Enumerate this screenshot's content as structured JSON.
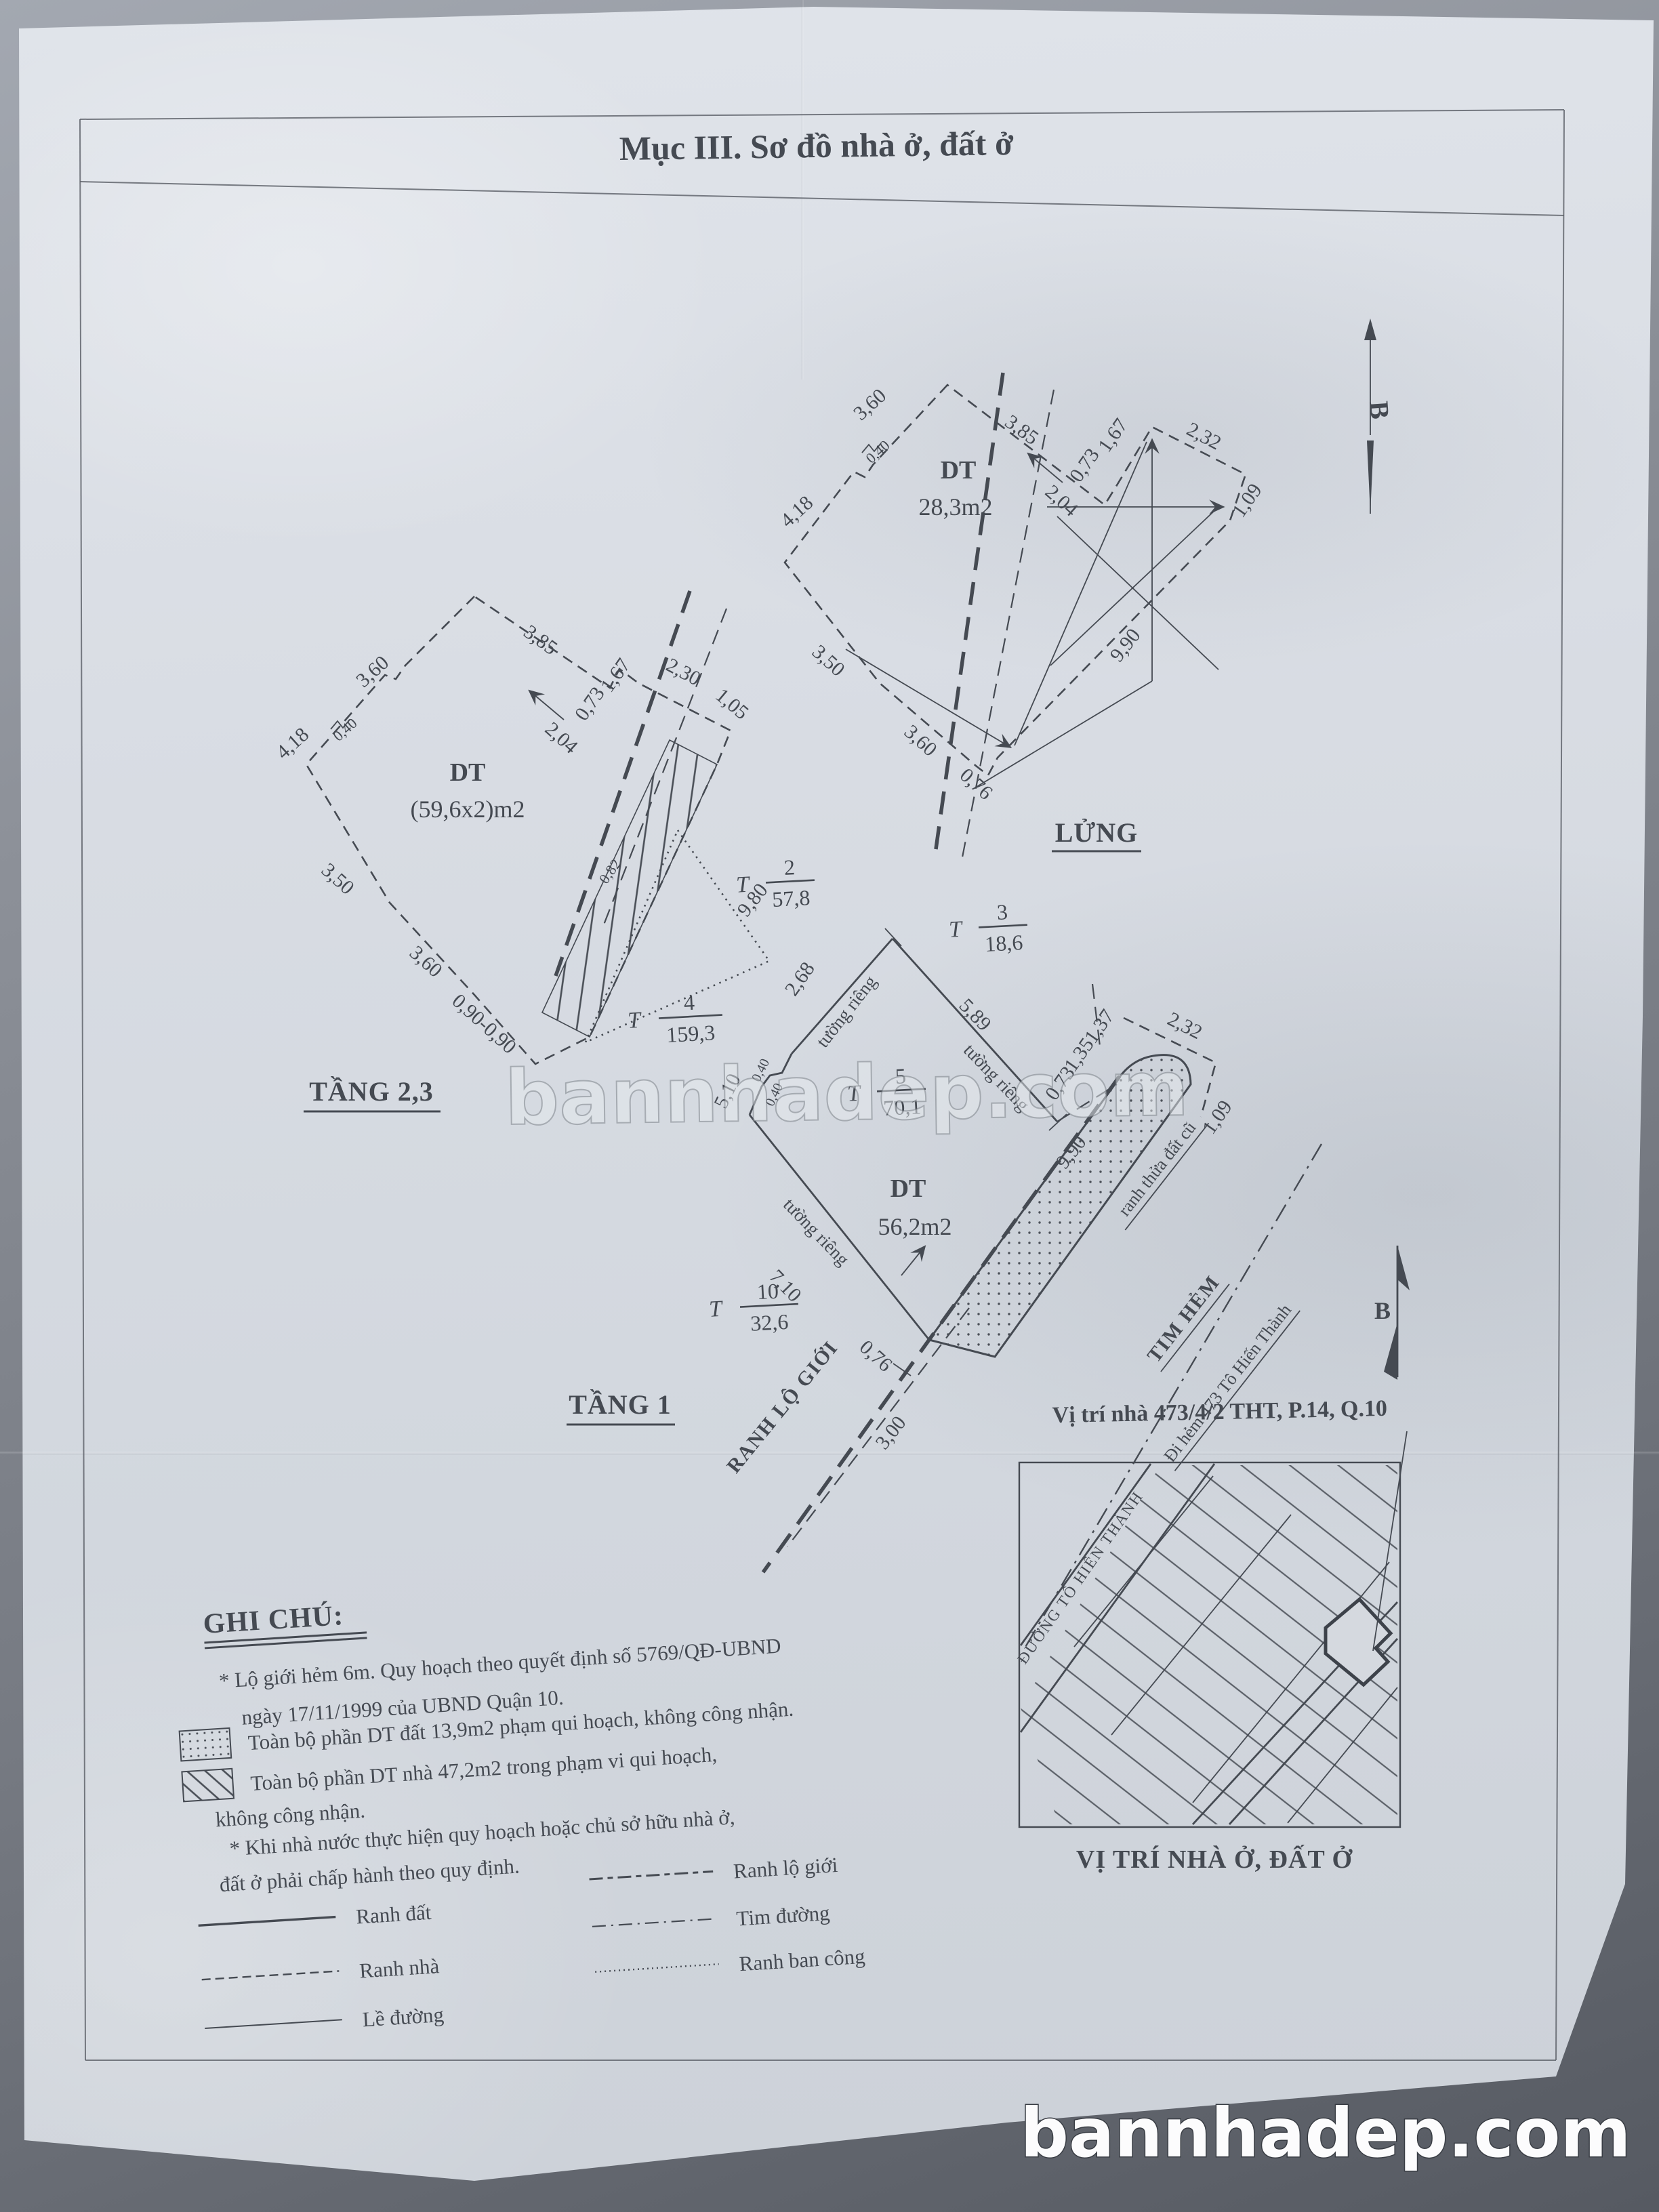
{
  "title": "Mục III. Sơ đồ nhà ở, đất ở",
  "watermark": {
    "text": "bannhadep.com"
  },
  "north": {
    "label": "B"
  },
  "lung": {
    "name": "LỬNG",
    "dt": "DT",
    "area": "28,3m2",
    "d360a": "3,60",
    "d385": "3,85",
    "d418": "4,18",
    "d040": "0,40",
    "d204": "2,04",
    "d073": "0,73",
    "d167": "1,67",
    "d232": "2,32",
    "d109": "1,09",
    "d990": "9,90",
    "d350": "3,50",
    "d360b": "3,60",
    "d076": "0,76"
  },
  "tang23": {
    "name": "TẦNG 2,3",
    "dt": "DT",
    "area": "(59,6x2)m2",
    "d360a": "3,60",
    "d385": "3,85",
    "d418": "4,18",
    "d040": "0,40",
    "d204": "2,04",
    "d073": "0,73",
    "d167": "1,67",
    "d230": "2,30",
    "d105": "1,05",
    "d980": "9,80",
    "d082": "0,82",
    "d350": "3,50",
    "d360b": "3,60",
    "d090": "0,90-0,90"
  },
  "tang1": {
    "name": "TẦNG 1",
    "dt": "DT",
    "area": "56,2m2",
    "d268": "2,68",
    "d510": "5,10",
    "d040a": "0,40",
    "d040b": "0,40",
    "d589": "5,89",
    "d710": "7,10",
    "d073": "0,73",
    "d135": "1,35",
    "d137": "1,37",
    "d232": "2,32",
    "d109": "1,09",
    "d990": "9,90",
    "d076": "0,76",
    "d300": "3,00",
    "wall1": "tường riêng",
    "wall2": "tường riêng",
    "wall3": "tường riêng",
    "ranh_lo_gioi": "RANH LỘ GIỚI",
    "ranh_thua": "ranh thửa đất cũ",
    "tim_hem": "TIM HẺM",
    "di_hem": "Đi hẻm 473 Tô Hiến Thành"
  },
  "parcels": [
    {
      "prefix": "T",
      "num": "2",
      "area": "57,8"
    },
    {
      "prefix": "T",
      "num": "3",
      "area": "18,6"
    },
    {
      "prefix": "T",
      "num": "4",
      "area": "159,3"
    },
    {
      "prefix": "T",
      "num": "5",
      "area": "70,1"
    },
    {
      "prefix": "T",
      "num": "10",
      "area": "32,6"
    }
  ],
  "location": {
    "line": "Vị trí nhà 473/4/2 THT, P.14, Q.10",
    "street": "ĐƯỜNG TÔ HIẾN THÀNH",
    "caption": "VỊ TRÍ NHÀ Ở, ĐẤT Ở"
  },
  "notes": {
    "heading": "GHI CHÚ:",
    "n1a": "* Lộ giới hẻm 6m. Quy hoạch theo quyết định số 5769/QĐ-UBND",
    "n1b": "ngày 17/11/1999 của UBND Quận 10.",
    "n2": "Toàn bộ phần DT đất 13,9m2 phạm qui hoạch, không công nhận.",
    "n3a": "Toàn bộ phần DT nhà 47,2m2 trong phạm vi qui hoạch,",
    "n3b": "không công nhận.",
    "n4a": "* Khi nhà nước thực hiện quy hoạch hoặc chủ sở hữu nhà ở,",
    "n4b": "đất ở phải chấp hành theo quy định."
  },
  "legend": [
    {
      "label": "Ranh đất"
    },
    {
      "label": "Ranh nhà"
    },
    {
      "label": "Lề đường"
    },
    {
      "label": "Ranh lộ giới"
    },
    {
      "label": "Tim đường"
    },
    {
      "label": "Ranh ban công"
    }
  ]
}
